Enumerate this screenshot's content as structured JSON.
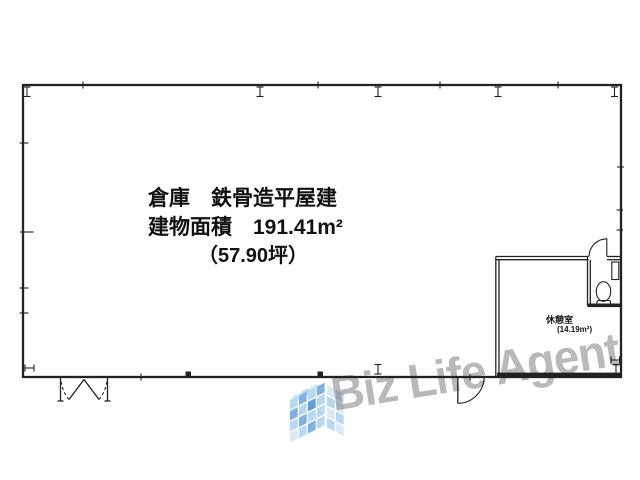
{
  "plan": {
    "building_label": {
      "line1": "倉庫　鉄骨造平屋建",
      "line2": "建物面積　191.41m²",
      "line3": "（57.90坪）"
    },
    "room": {
      "name": "休憩室",
      "area": "(14.19m²)"
    }
  },
  "watermark": {
    "text": "Biz Life Agent"
  },
  "colors": {
    "plan_line": "#222222",
    "watermark_text": "#9a9a9a",
    "logo_blue_dark": "#5f9fd9",
    "logo_blue_mid": "#7fb2e4",
    "logo_blue_light": "#b7d7f2",
    "logo_blue_pale": "#d9e9f8"
  }
}
